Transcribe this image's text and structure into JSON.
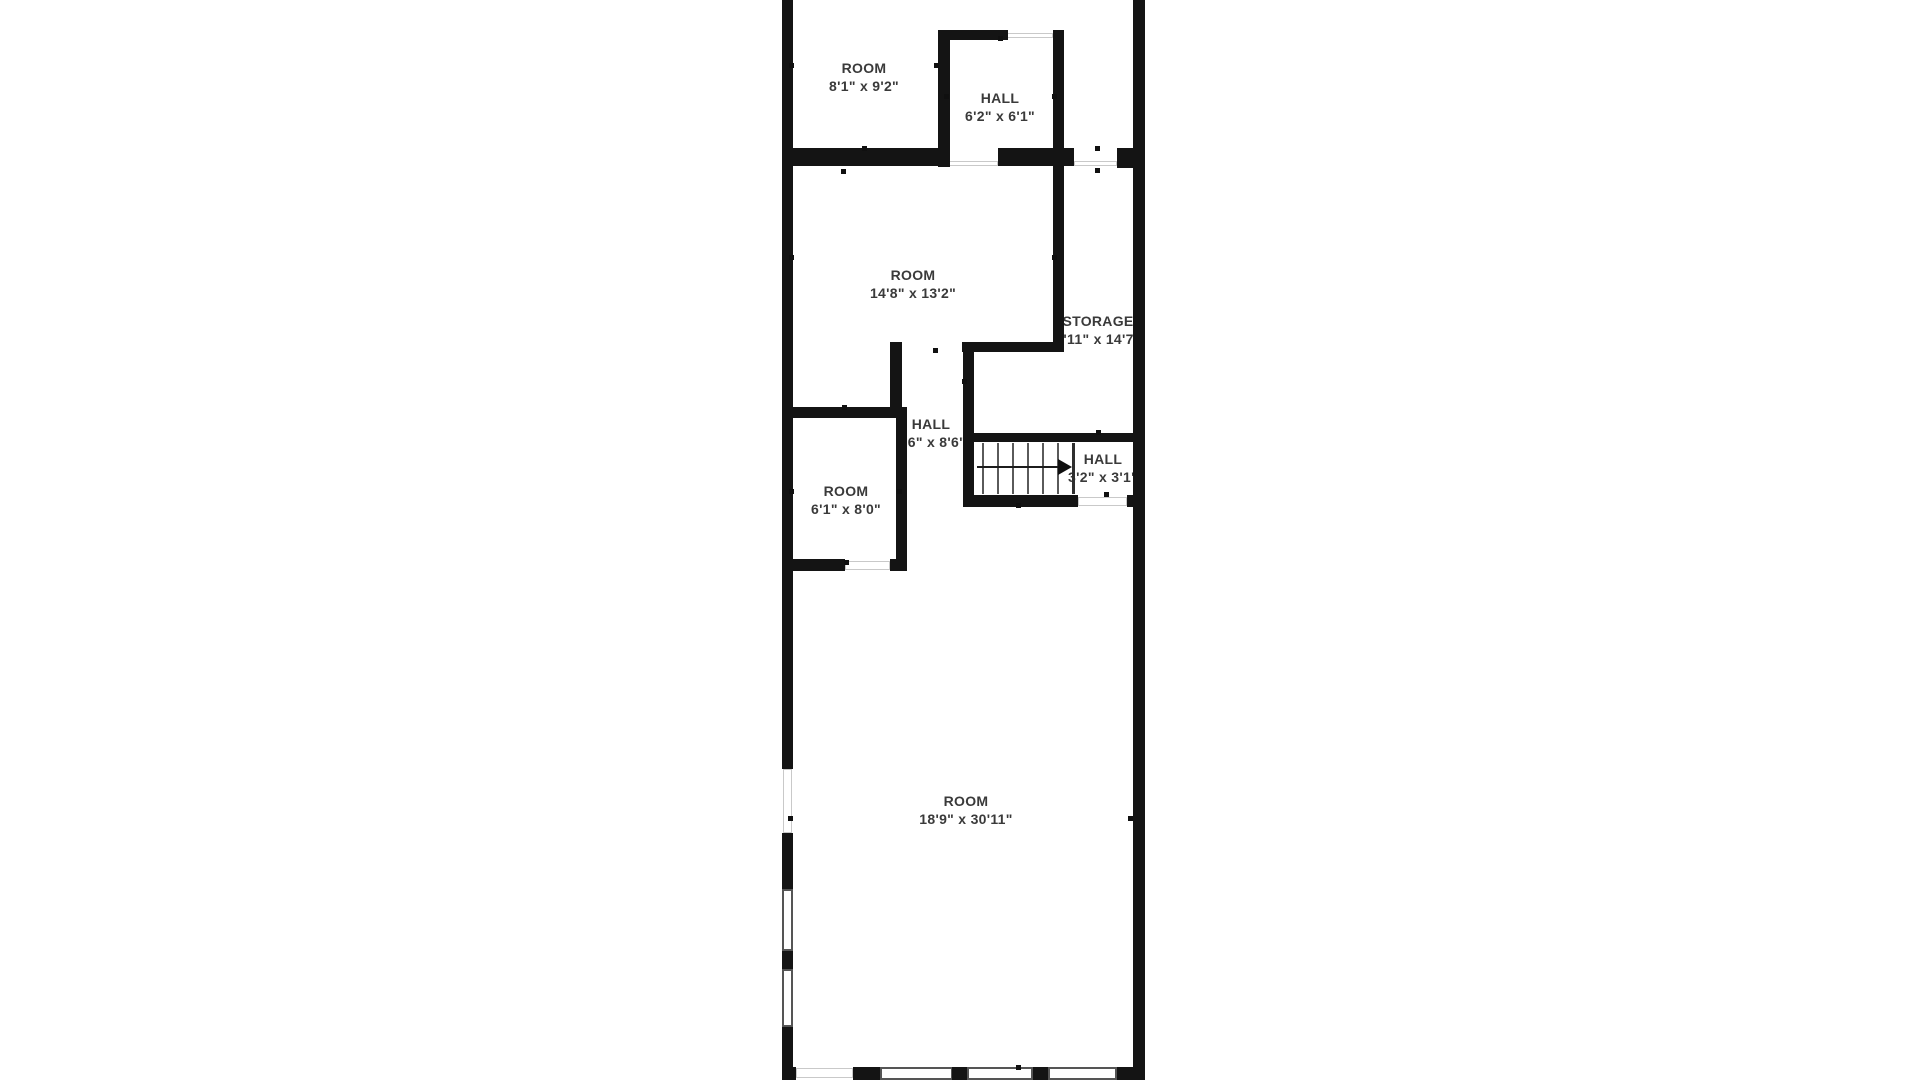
{
  "page": {
    "background": "#ffffff",
    "wall_color": "#141414",
    "label_color": "#3a3a3a"
  },
  "plan": {
    "rooms": [
      {
        "label": "ROOM",
        "dims": "8'1\" x 9'2\"",
        "cx": 864,
        "top": 59
      },
      {
        "label": "HALL",
        "dims": "6'2\" x 6'1\"",
        "cx": 1000,
        "top": 89
      },
      {
        "label": "ROOM",
        "dims": "14'8\" x 13'2\"",
        "cx": 913,
        "top": 266
      },
      {
        "label": "STORAGE",
        "dims": "3'11\" x 14'7\"",
        "cx": 1098,
        "top": 312
      },
      {
        "label": "HALL",
        "dims": "7'6\" x 8'6\"",
        "cx": 931,
        "top": 415
      },
      {
        "label": "HALL",
        "dims": "3'2\" x 3'1\"",
        "cx": 1103,
        "top": 450
      },
      {
        "label": "ROOM",
        "dims": "6'1\" x 8'0\"",
        "cx": 846,
        "top": 482
      },
      {
        "label": "ROOM",
        "dims": "18'9\" x 30'11\"",
        "cx": 966,
        "top": 792
      }
    ],
    "walls": [
      {
        "x": 782,
        "y": 0,
        "w": 11,
        "h": 769
      },
      {
        "x": 782,
        "y": 833,
        "w": 11,
        "h": 56
      },
      {
        "x": 782,
        "y": 951,
        "w": 11,
        "h": 18
      },
      {
        "x": 782,
        "y": 1027,
        "w": 11,
        "h": 53
      },
      {
        "x": 1133,
        "y": 0,
        "w": 12,
        "h": 1080
      },
      {
        "x": 938,
        "y": 30,
        "w": 12,
        "h": 137
      },
      {
        "x": 938,
        "y": 30,
        "w": 70,
        "h": 10
      },
      {
        "x": 1053,
        "y": 30,
        "w": 11,
        "h": 322
      },
      {
        "x": 782,
        "y": 148,
        "w": 161,
        "h": 18
      },
      {
        "x": 998,
        "y": 148,
        "w": 76,
        "h": 18
      },
      {
        "x": 1117,
        "y": 148,
        "w": 16,
        "h": 20
      },
      {
        "x": 890,
        "y": 342,
        "w": 12,
        "h": 76
      },
      {
        "x": 962,
        "y": 342,
        "w": 100,
        "h": 10
      },
      {
        "x": 963,
        "y": 342,
        "w": 11,
        "h": 165
      },
      {
        "x": 782,
        "y": 407,
        "w": 125,
        "h": 11
      },
      {
        "x": 896,
        "y": 407,
        "w": 11,
        "h": 164
      },
      {
        "x": 782,
        "y": 559,
        "w": 63,
        "h": 12
      },
      {
        "x": 890,
        "y": 559,
        "w": 17,
        "h": 12
      },
      {
        "x": 965,
        "y": 433,
        "w": 178,
        "h": 9
      },
      {
        "x": 965,
        "y": 495,
        "w": 113,
        "h": 12
      },
      {
        "x": 1127,
        "y": 495,
        "w": 16,
        "h": 12
      },
      {
        "x": 782,
        "y": 1067,
        "w": 14,
        "h": 13
      },
      {
        "x": 853,
        "y": 1067,
        "w": 27,
        "h": 13
      },
      {
        "x": 952,
        "y": 1067,
        "w": 15,
        "h": 13
      },
      {
        "x": 1033,
        "y": 1067,
        "w": 15,
        "h": 13
      },
      {
        "x": 1117,
        "y": 1067,
        "w": 28,
        "h": 13
      }
    ],
    "windows": [
      {
        "x": 782,
        "y": 889,
        "w": 11,
        "h": 62
      },
      {
        "x": 782,
        "y": 969,
        "w": 11,
        "h": 58
      },
      {
        "x": 880,
        "y": 1067,
        "w": 73,
        "h": 13
      },
      {
        "x": 967,
        "y": 1067,
        "w": 66,
        "h": 13
      },
      {
        "x": 1048,
        "y": 1067,
        "w": 69,
        "h": 13
      }
    ],
    "openings": [
      {
        "x": 1007,
        "y": 33,
        "w": 46,
        "h": 5
      },
      {
        "x": 943,
        "y": 161,
        "w": 55,
        "h": 5
      },
      {
        "x": 1074,
        "y": 161,
        "w": 43,
        "h": 5
      },
      {
        "x": 845,
        "y": 561,
        "w": 45,
        "h": 9
      },
      {
        "x": 1078,
        "y": 497,
        "w": 49,
        "h": 9
      },
      {
        "x": 796,
        "y": 1068,
        "w": 57,
        "h": 10
      },
      {
        "x": 783,
        "y": 769,
        "w": 9,
        "h": 64
      }
    ],
    "dots": [
      {
        "x": 789,
        "y": 63
      },
      {
        "x": 934,
        "y": 63
      },
      {
        "x": 944,
        "y": 94
      },
      {
        "x": 1052,
        "y": 94
      },
      {
        "x": 998,
        "y": 36
      },
      {
        "x": 862,
        "y": 146
      },
      {
        "x": 841,
        "y": 169
      },
      {
        "x": 1095,
        "y": 146
      },
      {
        "x": 1095,
        "y": 168
      },
      {
        "x": 789,
        "y": 255
      },
      {
        "x": 1052,
        "y": 255
      },
      {
        "x": 933,
        "y": 348
      },
      {
        "x": 962,
        "y": 379
      },
      {
        "x": 842,
        "y": 405
      },
      {
        "x": 789,
        "y": 489
      },
      {
        "x": 897,
        "y": 489
      },
      {
        "x": 844,
        "y": 560
      },
      {
        "x": 1096,
        "y": 430
      },
      {
        "x": 1104,
        "y": 492
      },
      {
        "x": 1016,
        "y": 503
      },
      {
        "x": 788,
        "y": 816
      },
      {
        "x": 1128,
        "y": 816
      },
      {
        "x": 1016,
        "y": 1065
      }
    ],
    "stairs": {
      "tread_top": 443,
      "tread_bottom": 494,
      "treads": [
        982,
        997,
        1012,
        1027,
        1042,
        1057
      ],
      "divider_x": 1072,
      "line_y": 466,
      "line_x1": 977,
      "line_x2": 1058,
      "arrow_x": 1058,
      "arrow_y": 459
    }
  }
}
